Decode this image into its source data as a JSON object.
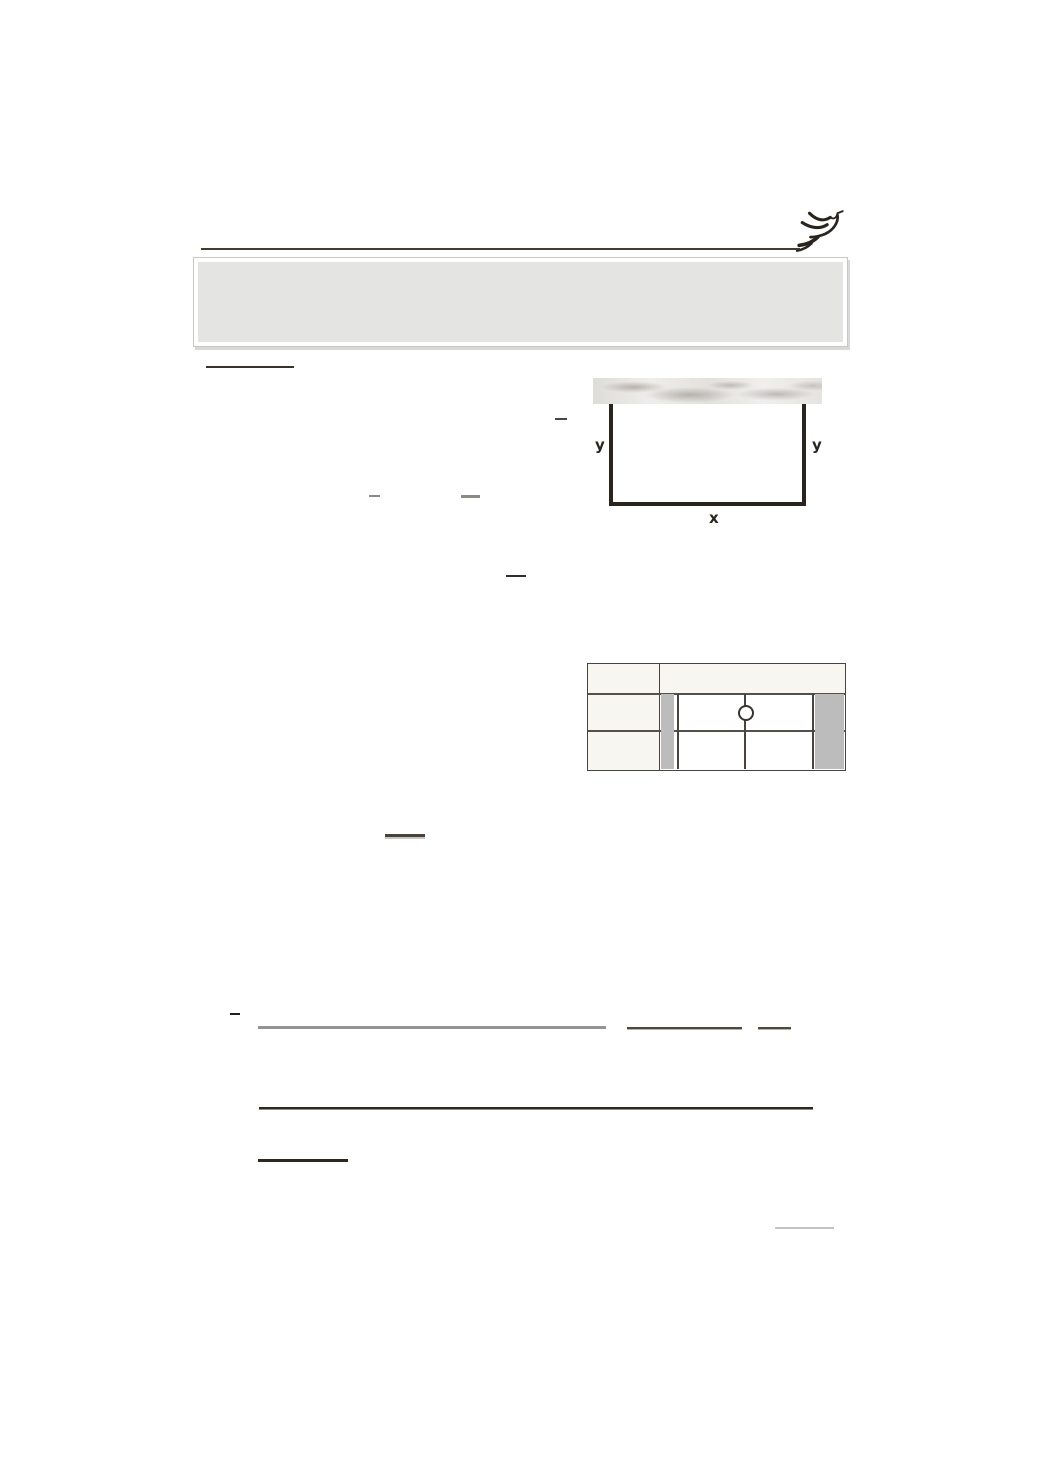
{
  "page": {
    "type": "scanned worksheet page, mostly blank",
    "background": "#ffffff"
  },
  "header": {
    "logo": "dove-sketch",
    "rule_color": "#443b31",
    "panel": {
      "fill": "#e4e4e3",
      "border": "#c7c7c6",
      "bevel": "#ffffff"
    }
  },
  "figure": {
    "description": "three-sided rectangle attached to a marble wall band",
    "wall_texture": "marble",
    "line_color": "#2b241e",
    "labels": {
      "left": "y",
      "right": "y",
      "bottom": "x"
    }
  },
  "table": {
    "description": "number-line table, two rows, open circle marker at center of first row",
    "border_color": "#4a443e",
    "header_fill": "#f7f6f1",
    "band_fill": "#bcbcbc",
    "marker": "open-circle"
  },
  "rules": {
    "dark": "#2e2722",
    "medium": "#4f4841",
    "gray": "#949494",
    "light": "#c4c4c4"
  }
}
